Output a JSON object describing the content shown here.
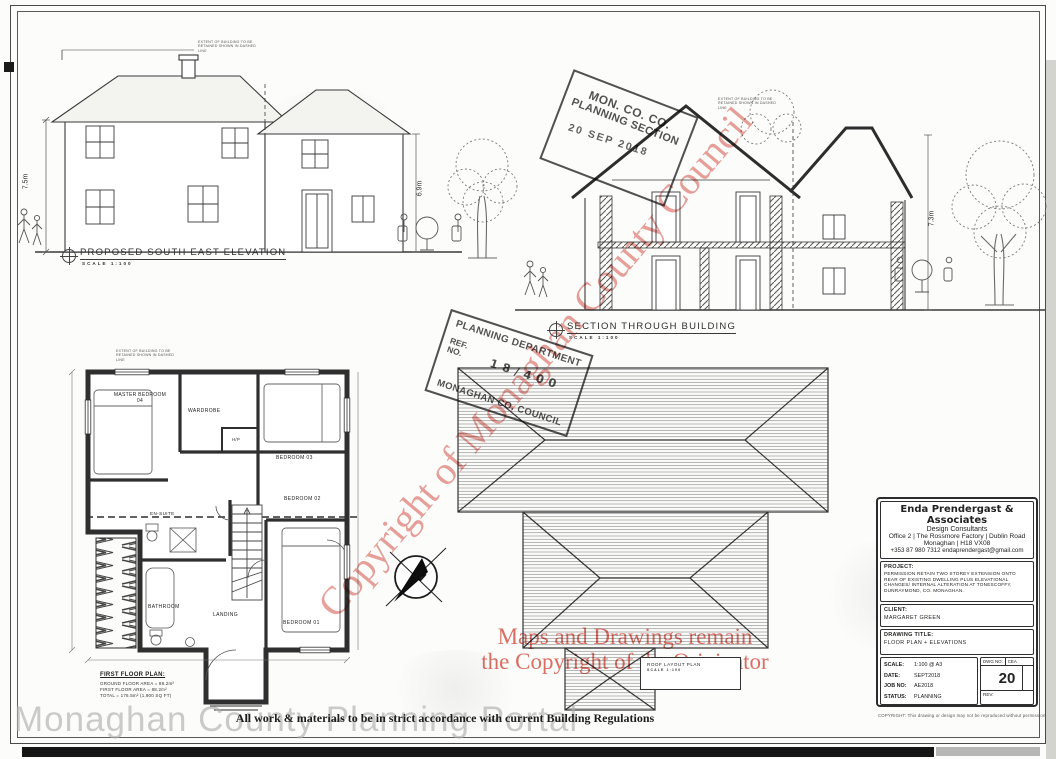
{
  "sheet": {
    "regulations_note": "All work & materials to be in strict accordance with current Building Regulations",
    "portal_watermark": "Monaghan County Planning Portal"
  },
  "colors": {
    "watermark_red": "#d65248",
    "stamp_ink": "#3a3a3a",
    "line_ink": "#333333"
  },
  "watermarks": {
    "diagonal_text": "Copyright of Monaghan County Council",
    "red_line1": "Maps and Drawings remain",
    "red_line2": "the Copyright of the Originator"
  },
  "stamps": {
    "planning_section": {
      "line1": "MON. CO. CO.",
      "line2": "PLANNING SECTION",
      "date": "20 SEP 2018"
    },
    "planning_department": {
      "title": "PLANNING DEPARTMENT",
      "ref_line1": "REF.",
      "ref_line2": "NO.",
      "ref_value": "18/400",
      "footer": "MONAGHAN CO. COUNCIL"
    }
  },
  "drawings": {
    "retain_note": "EXTENT OF BUILDING TO BE RETAINED SHOWN IN DASHED LINE",
    "elevation": {
      "title": "PROPOSED SOUTH EAST ELEVATION",
      "scale": "SCALE 1:100",
      "dim_left": "7.5m",
      "dim_right": "6.9m"
    },
    "section": {
      "title": "SECTION THROUGH BUILDING",
      "scale": "SCALE 1:100",
      "dim_right": "7.3m"
    },
    "floor_plan": {
      "title": "FIRST FLOOR PLAN:",
      "area_line1": "GROUND FLOOR AREA = 88.2m²",
      "area_line2": "FIRST FLOOR AREA = 88.2m²",
      "area_line3": "TOTAL = 176.5m² (1,900 SQ FT)",
      "rooms": {
        "master": "MASTER BEDROOM 04",
        "wardrobe": "WARDROBE",
        "hp": "H/P",
        "bed3": "BEDROOM 03",
        "bed2": "BEDROOM 02",
        "ensuite": "EN-SUITE",
        "bathroom": "BATHROOM",
        "landing": "LANDING",
        "bed1": "BEDROOM 01"
      }
    },
    "roof_plan": {
      "title": "ROOF LAYOUT PLAN",
      "scale": "SCALE 1:100"
    },
    "compass_north": "N"
  },
  "title_block": {
    "company": "Enda Prendergast & Associates",
    "subtitle": "Design Consultants",
    "address1": "Office 2 | The Rossmore Factory | Dublin Road",
    "address2": "Monaghan | H18 VX08",
    "contact": "+353 87 980 7312 endaprendergast@gmail.com",
    "project_label": "PROJECT:",
    "project_text": "PERMISSION RETAIN TWO STOREY EXTENSION ONTO REAR OF EXISTING DWELLING PLUS ELEVATIONAL CHANGES/ INTERNAL ALTERATION AT TONESCOFFY, DUNRAYMOND, CO. MONAGHAN.",
    "client_label": "CLIENT:",
    "client_name": "MARGARET GREEN",
    "drawing_title_label": "DRAWING TITLE:",
    "drawing_title": "FLOOR PLAN + ELEVATIONS",
    "scale_label": "SCALE:",
    "scale_value": "1:100 @ A3",
    "date_label": "DATE:",
    "date_value": "SEPT2018",
    "job_label": "JOB NO:",
    "job_value": "AE2018",
    "status_label": "STATUS:",
    "status_value": "PLANNING",
    "dwg_label": "DWG NO:",
    "dwg_prefix": "CEA",
    "dwg_number": "20",
    "rev_label": "REV:",
    "copyright_note": "COPYRIGHT: This drawing or design may not be reproduced without permission"
  }
}
